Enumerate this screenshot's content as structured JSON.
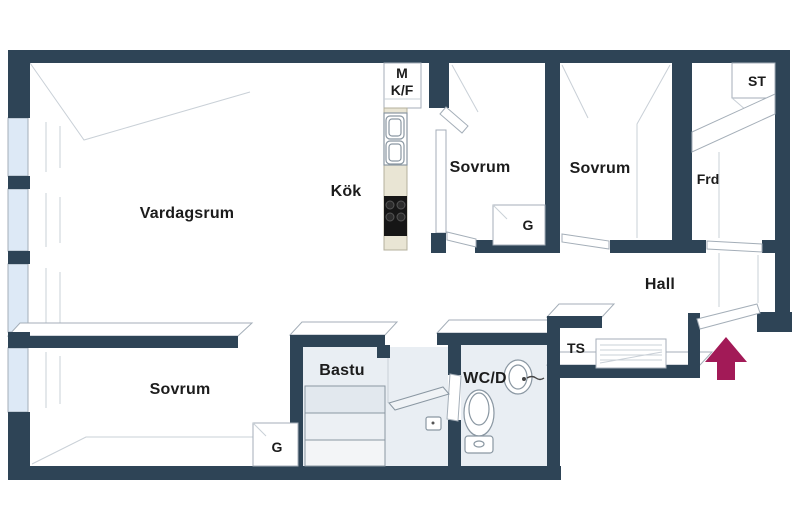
{
  "plan": {
    "type": "apartment-floor-plan",
    "labels": {
      "vardagsrum": "Vardagsrum",
      "kok": "Kök",
      "sovrum_1": "Sovrum",
      "sovrum_2": "Sovrum",
      "sovrum_3": "Sovrum",
      "hall": "Hall",
      "bastu": "Bastu",
      "wc_d": "WC/D",
      "frd": "Frd",
      "st": "ST",
      "ts": "TS",
      "garderob_1": "G",
      "garderob_2": "G",
      "cabinet_line_1": "M",
      "cabinet_line_2": "K/F"
    },
    "icons": {
      "entrance_arrow": "up-arrow",
      "kitchen_sink": "double-basin",
      "stove": "4-burner",
      "toilet": "wc",
      "washbasin": "oval-sink",
      "sauna_benches": "stepped-benches",
      "slatted_rack": "horizontal-slats"
    },
    "colors": {
      "wall": "#2e4456",
      "glass": "#dde9f6",
      "wet_floor": "#e9eef3",
      "bench": "#e2e8ee",
      "counter": "#e9e5d4",
      "stove": "#161616",
      "arrow": "#a21a57",
      "line": "#c9d0d7",
      "line_strong": "#a4aeb8",
      "fixture": "#8a97a2",
      "label": "#1c1c1c"
    }
  }
}
